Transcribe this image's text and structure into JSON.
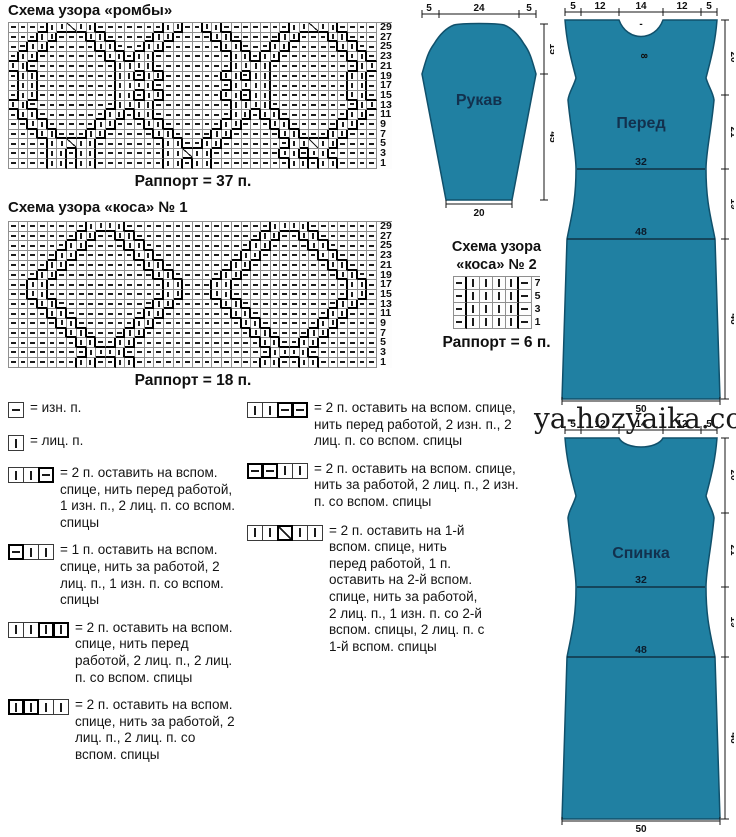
{
  "colors": {
    "piece_fill": "#2080a2",
    "piece_outline": "#10506b",
    "piece_label": "#12314e"
  },
  "watermark": "ya-hozyaika.com",
  "charts": [
    {
      "title": "Схема узора «ромбы»",
      "rapport": "Раппорт = 37 п.",
      "row_numbers": [
        "29",
        "27",
        "25",
        "23",
        "21",
        "19",
        "17",
        "15",
        "13",
        "11",
        "9",
        "7",
        "5",
        "3",
        "1"
      ],
      "rows": [
        "----||/||-------||--||-------||/||----",
        "---||---||-----||----||-----||---||---",
        "--||-----||---||------||---||-----||--",
        "-||-------||-||--------||-||-------||-",
        "||---------||||--------||||---------||",
        "-||--------||-||------||-||--------||-",
        "-||--------||||--------||||--------||-",
        "-||--------||-||------||-||--------||-",
        "||---------||||--------||||---------||",
        "-||-------||-||--------||-||-------||-",
        "--||-----||---||------||---||-----||--",
        "---||---||-----||----||-----||---||---",
        "----||/||-------||--||-------||/||----",
        "----||-||-------||/||-------||-||-----",
        "----||-||-------||-||--------||-||----"
      ]
    },
    {
      "title": "Схема узора «коса» № 1",
      "rapport": "Раппорт = 18 п.",
      "row_numbers": [
        "29",
        "27",
        "25",
        "23",
        "21",
        "19",
        "17",
        "15",
        "13",
        "11",
        "9",
        "7",
        "5",
        "3",
        "1"
      ],
      "rows": [
        "--------||||---------------||||-------",
        "-------||--||-------------||--||------",
        "------||----||-----------||----||-----",
        "-----||------||---------||------||----",
        "----||--------||-------||--------||---",
        "---||----------||-----||----------||--",
        "--||------------||---||------------||-",
        "--||------------||---||------------||-",
        "---||----------||-----||----------||--",
        "----||--------||-------||--------||---",
        "-----||------||---------||------||----",
        "------||----||-----------||----||-----",
        "-------||--||-------------||--||------",
        "--------||||---------------||||-------",
        "-------||--||-------------||--||------"
      ]
    },
    {
      "title_line1": "Схема узора",
      "title_line2": "«коса» № 2",
      "rapport": "Раппорт = 6 п.",
      "row_numbers": [
        "7",
        "5",
        "3",
        "1"
      ],
      "rows": [
        "-||||-",
        "-||||-",
        "-||||-",
        "-||||-"
      ]
    }
  ],
  "legend": {
    "left": [
      {
        "sym": "-",
        "bold": "0",
        "text": "= изн. п."
      },
      {
        "sym": "|",
        "bold": "0",
        "text": "= лиц. п."
      },
      {
        "sym": "||-",
        "bold": "001",
        "text": "= 2 п. оставить на вспом. спице, нить перед работой, 1 изн. п., 2 лиц. п. со вспом. спицы"
      },
      {
        "sym": "-||",
        "bold": "100",
        "text": "= 1 п. оставить на вспом. спице, нить за работой, 2 лиц. п., 1 изн. п. со вспом. спицы"
      },
      {
        "sym": "||||",
        "bold": "0011",
        "text": "= 2 п. оставить на вспом. спице, нить перед работой, 2 лиц. п., 2 лиц. п. со вспом. спицы"
      },
      {
        "sym": "||||",
        "bold": "1100",
        "text": "= 2 п. оставить на вспом. спице, нить за работой, 2 лиц. п., 2 лиц. п. со вспом. спицы"
      }
    ],
    "middle": [
      {
        "sym": "||--",
        "bold": "0011",
        "text": "= 2 п. оставить на вспом. спице, нить перед работой, 2 изн. п., 2 лиц. п. со вспом. спицы"
      },
      {
        "sym": "--||",
        "bold": "1100",
        "text": "= 2 п. оставить на вспом. спице, нить за работой, 2 лиц. п., 2 изн. п. со вспом. спицы"
      },
      {
        "sym": "||/||",
        "bold": "00100",
        "text": "= 2 п. оставить на 1-й вспом. спице, нить перед работой, 1 п. оставить на 2-й вспом. спице, нить за работой, 2 лиц. п., 1 изн. п. со 2-й вспом. спицы, 2 лиц. п. с 1-й вспом. спицы"
      }
    ]
  },
  "pieces": {
    "sleeve": {
      "label": "Рукав",
      "dim_top": [
        "5",
        "24",
        "5"
      ],
      "dim_right": [
        "15",
        "45"
      ],
      "dim_bottom": "20"
    },
    "front": {
      "label": "Перед",
      "dim_top": [
        "5",
        "12",
        "14",
        "12",
        "5"
      ],
      "neck_dash": "-",
      "neck_depth": "8",
      "dim_right": [
        "20",
        "21",
        "19",
        "46"
      ],
      "dim_inner": [
        "32",
        "48"
      ],
      "dim_bottom": "50"
    },
    "back": {
      "label": "Спинка",
      "dim_top": [
        "5",
        "12",
        "14",
        "12",
        "5"
      ],
      "dim_right": [
        "20",
        "21",
        "19",
        "46"
      ],
      "dim_inner": [
        "32",
        "48"
      ],
      "dim_bottom": "50"
    }
  }
}
